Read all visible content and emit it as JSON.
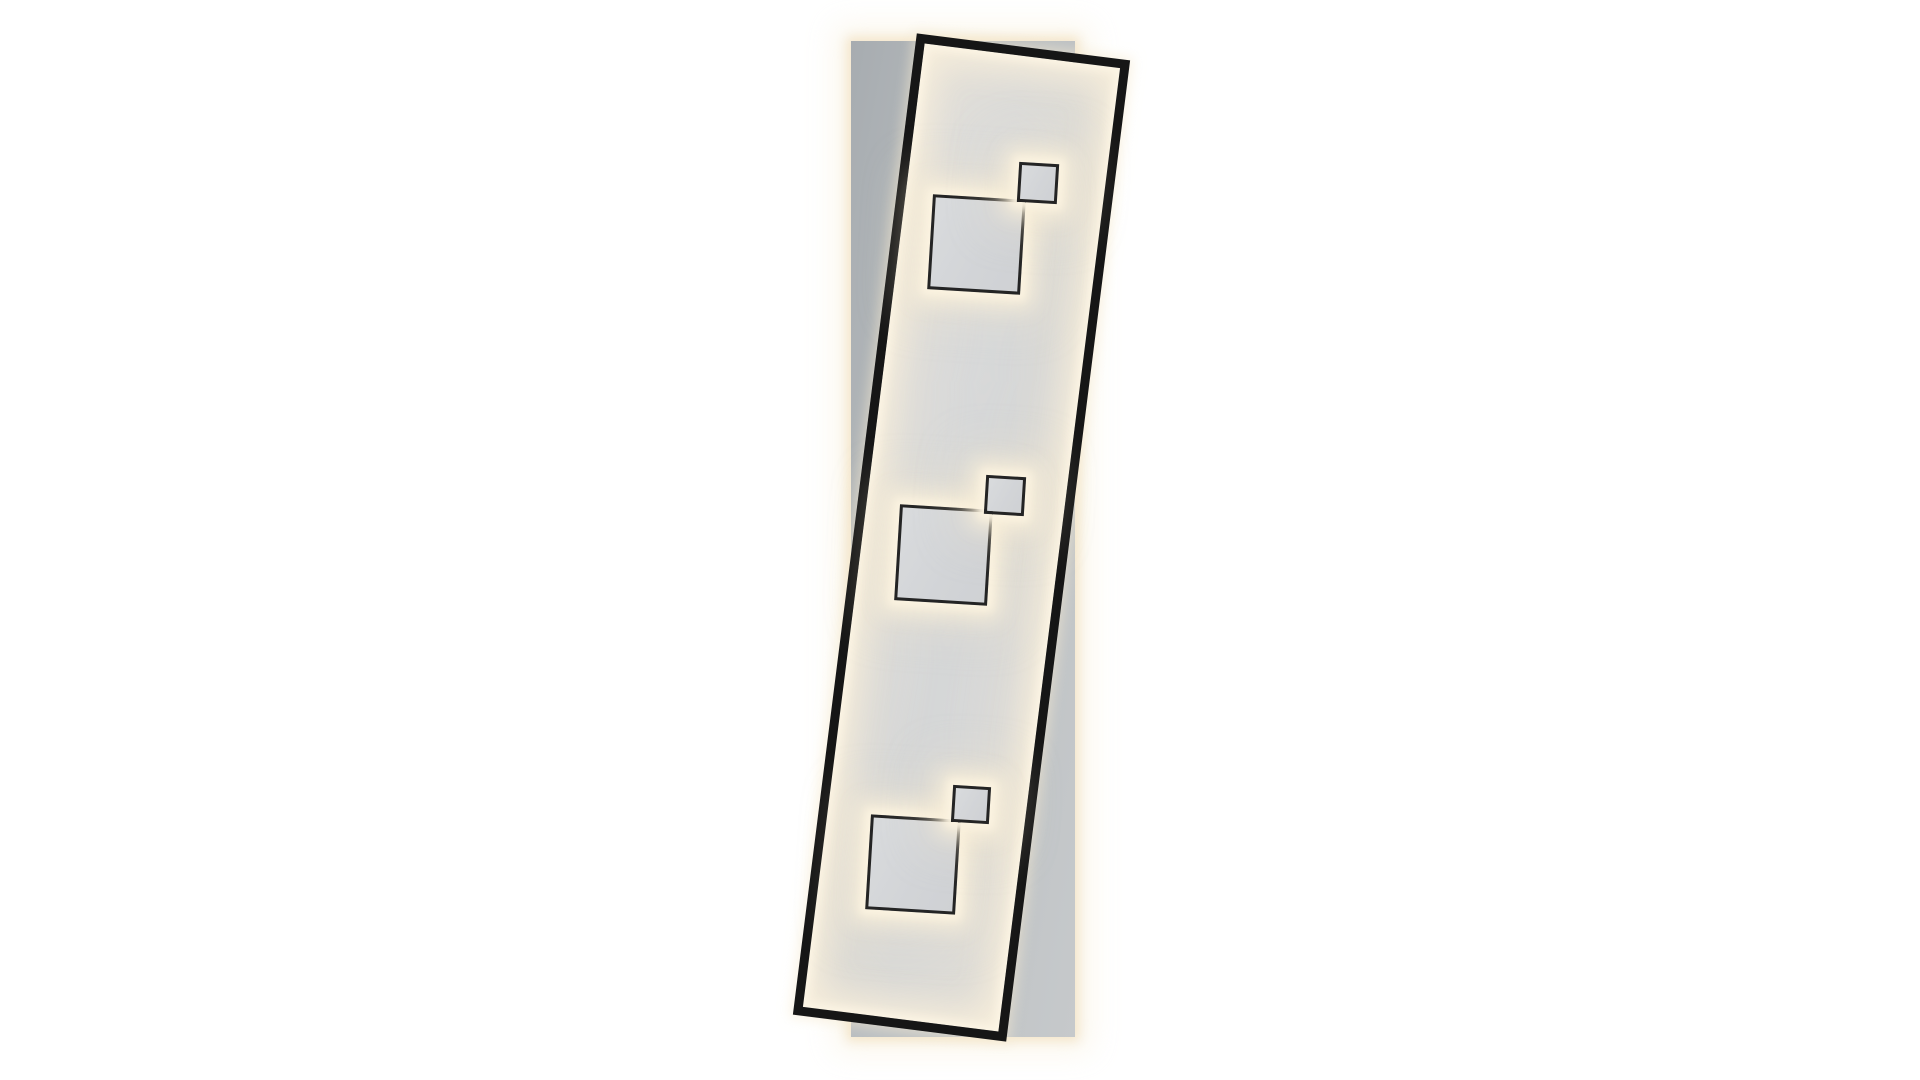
{
  "image": {
    "type": "product-photo",
    "subject": "Modern LED panel light: a tilted rectangular black-framed diffuser panel mounted over a grey rectangular backplate, edge-lit with warm white LED glow, featuring three pairs of back-lit squares (one large square with a small square overlapping its top-right corner), arranged top, middle and bottom",
    "background_color": "#ffffff",
    "visible_text": "none"
  },
  "colors": {
    "background": "#ffffff",
    "frame_black": "#161616",
    "square_border_black": "#242424",
    "backplate_gray_dark": "#a7acb0",
    "backplate_gray_light": "#c6c9cb",
    "diffuser_gray_light": "#dcdddf",
    "diffuser_gray_dark": "#d4d6d8",
    "square_gray": "#d3d5d8",
    "glow_warm_bright": "#fdf6e6",
    "glow_warm_soft": "#f2e7ce"
  },
  "fixture": {
    "frame": "black rectangular frame, tilted clockwise ~7 degrees",
    "backplate": "upright grey rectangle behind the frame with warm halo",
    "lighting": "warm white LED edge glow inside frame and around each square",
    "square_groups": [
      {
        "position": "top",
        "large_square": "grey, black border, glowing halo",
        "small_square": "overlaps large square top-right corner"
      },
      {
        "position": "middle",
        "large_square": "grey, black border, glowing halo",
        "small_square": "overlaps large square top-right corner"
      },
      {
        "position": "bottom",
        "large_square": "grey, black border, glowing halo",
        "small_square": "overlaps large square top-right corner"
      }
    ]
  }
}
